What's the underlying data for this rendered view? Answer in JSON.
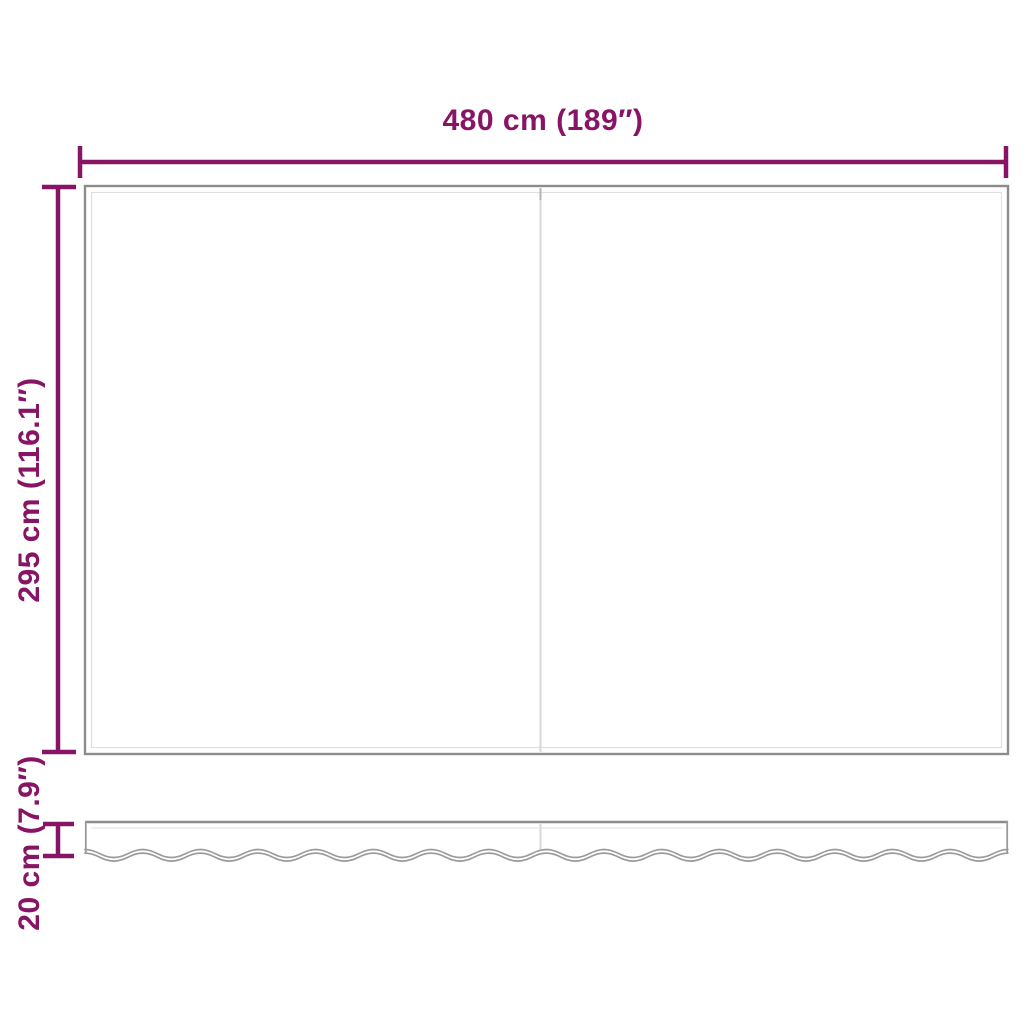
{
  "diagram": {
    "dimensions": {
      "width_label": "480 cm (189″)",
      "height_label": "295 cm (116.1″)",
      "valance_label": "20 cm (7.9″)"
    },
    "colors": {
      "accent": "#871465",
      "panel_outline": "#8c8c8c",
      "panel_inner_hairline": "#e0e0e0",
      "seam": "#d8d8d8",
      "wave_outline": "#9a9a9a",
      "background": "#ffffff"
    }
  }
}
